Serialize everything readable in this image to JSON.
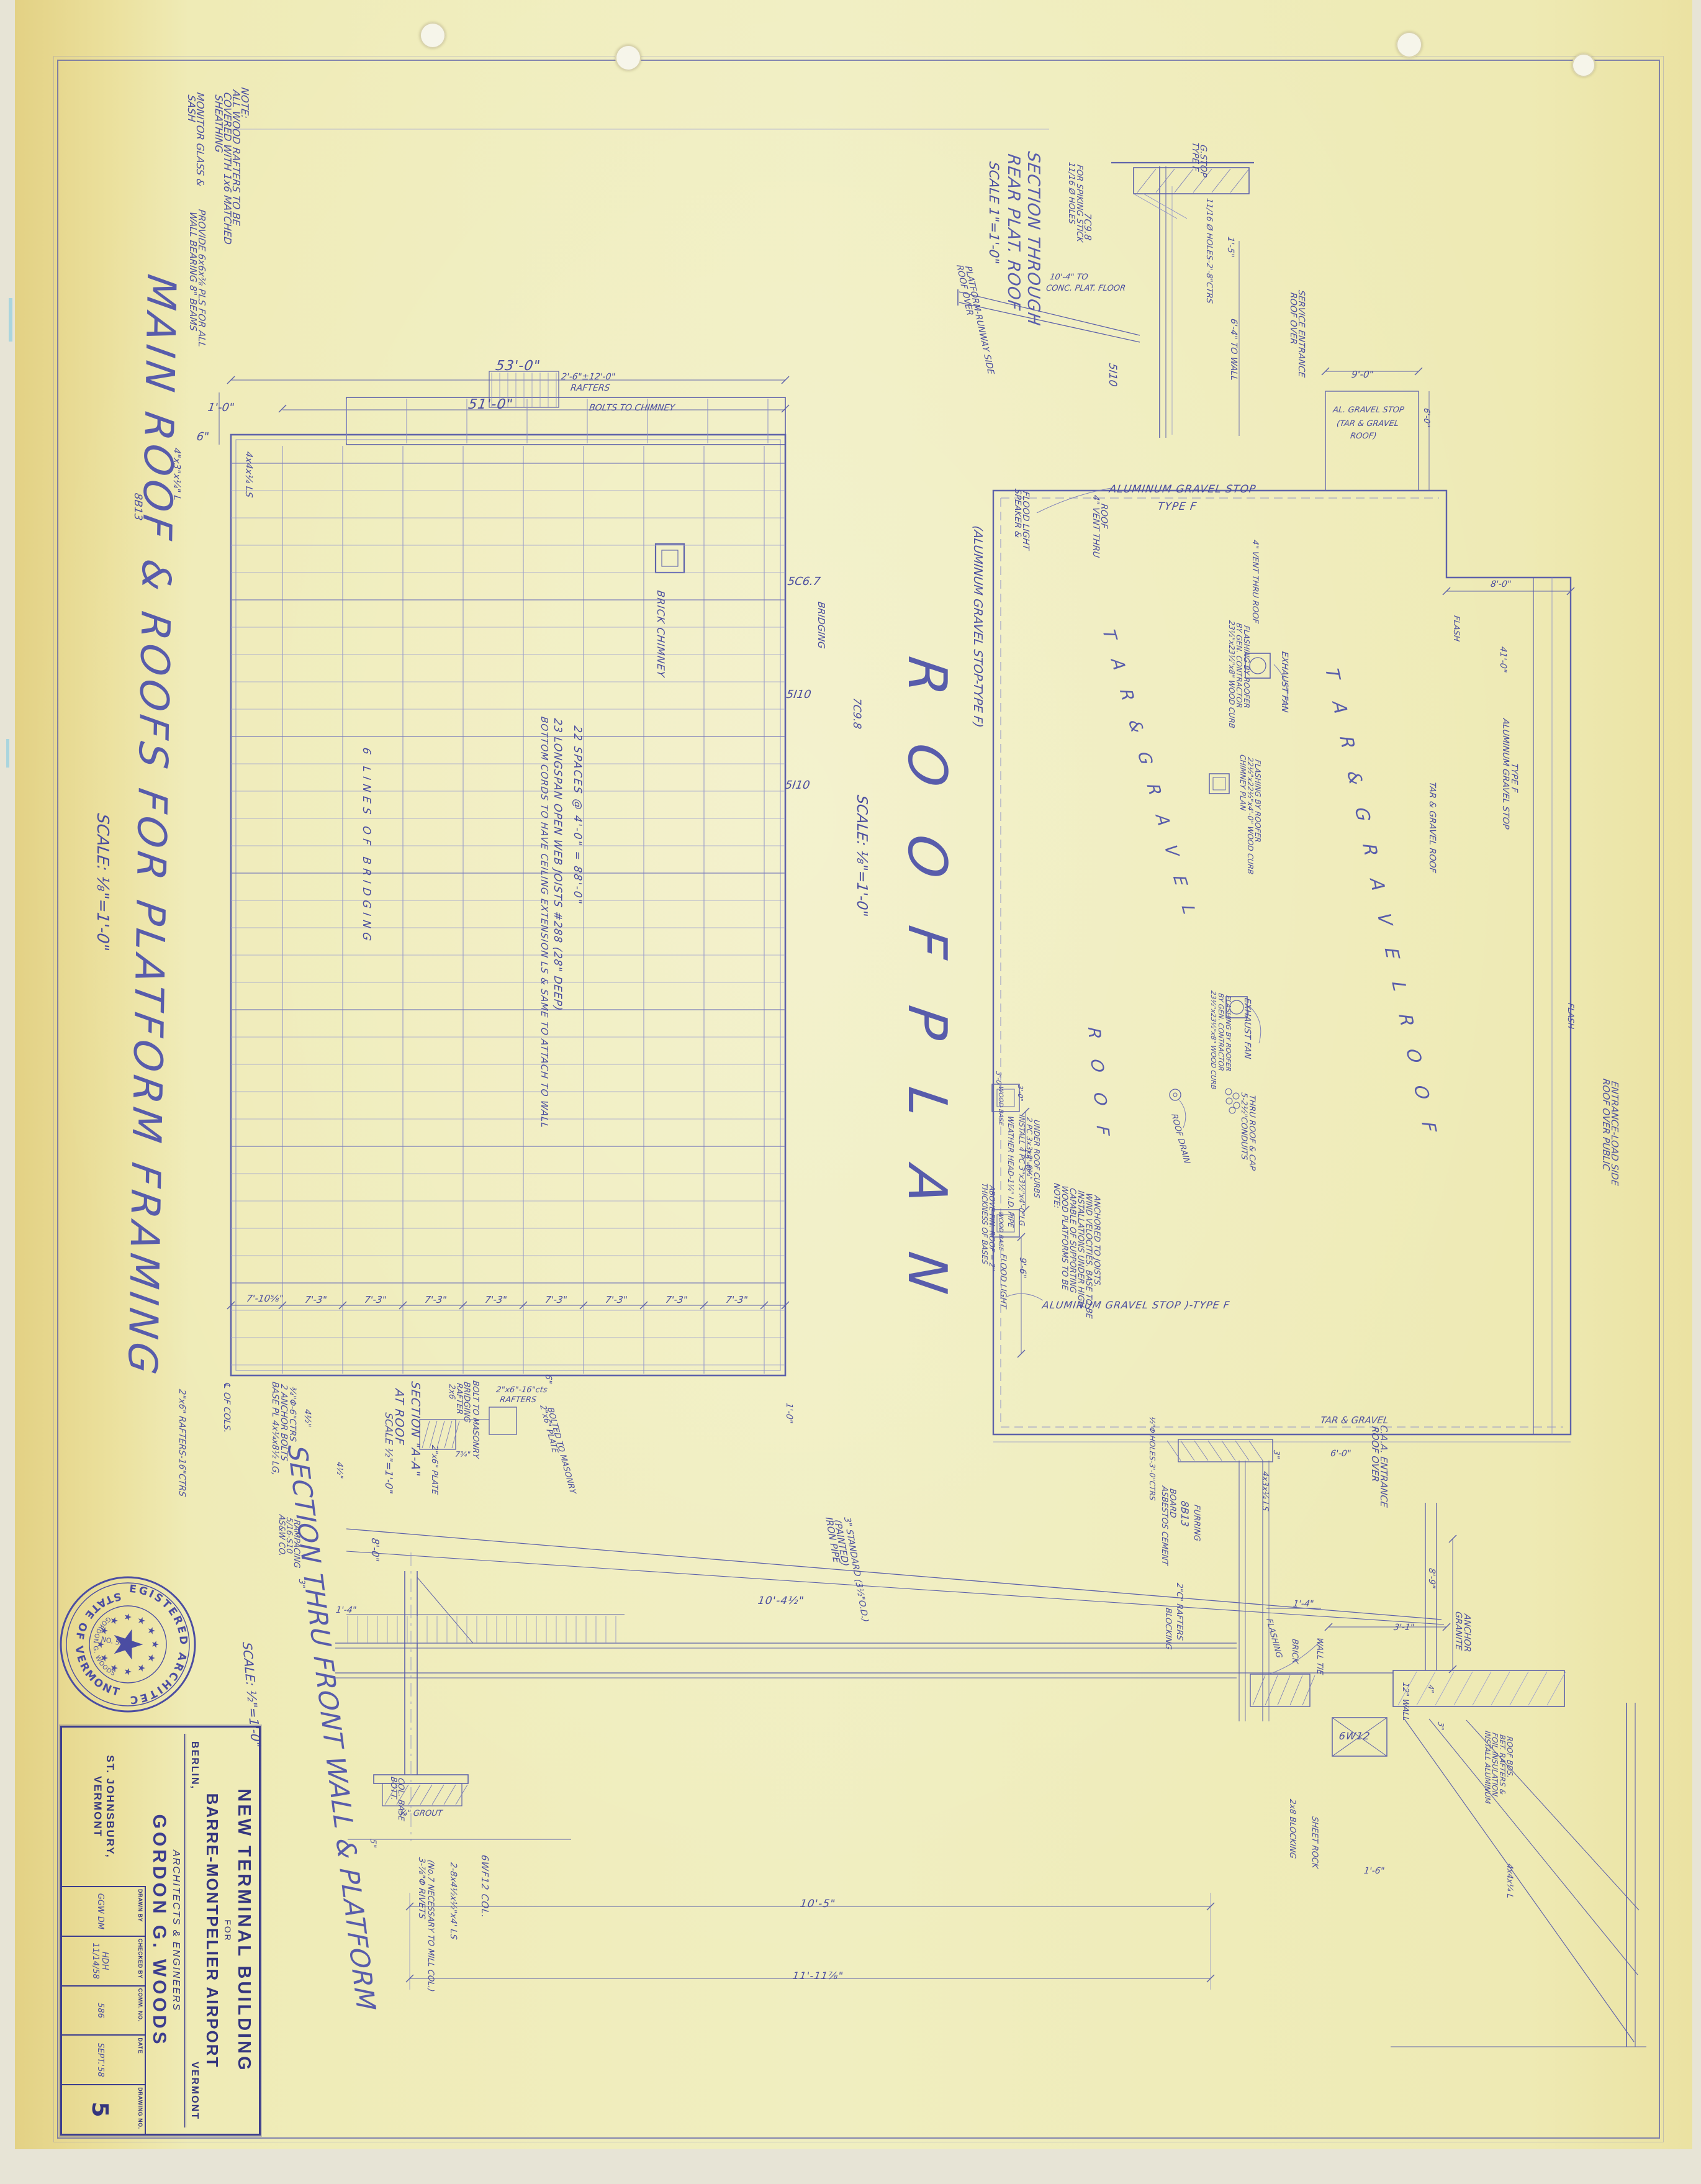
{
  "sheet": {
    "main_title": "MAIN ROOF & ROOFS FOR PLATFORM FRAMING",
    "main_title_scale": "SCALE: ⅛\"=1'-0\""
  },
  "title_block": {
    "project_title": "NEW TERMINAL BUILDING",
    "project_for": "FOR",
    "project_airport": "BARRE-MONTPELIER AIRPORT",
    "loc_left": "BERLIN,",
    "loc_right": "VERMONT",
    "arch_line": "ARCHITECTS & ENGINEERS",
    "firm": "GORDON G. WOODS",
    "firm_city": "ST. JOHNSBURY,  VERMONT",
    "fields": {
      "drawn_by_label": "DRAWN BY",
      "drawn_by": "GGW DM",
      "checked_by_label": "CHECKED BY",
      "checked_by": "HDH 11/14/58",
      "comm_no_label": "COMM. NO.",
      "comm_no": "586",
      "date_label": "DATE",
      "date": "SEPT.'58",
      "drawing_no_label": "DRAWING NO.",
      "drawing_no": "5"
    }
  },
  "seal": {
    "arc_top": "REGISTERED ARCHITECT",
    "arc_bottom": "STATE OF VERMONT",
    "inner_name": "GORDON G. WOODS",
    "number": "NO. 53",
    "star": "★"
  },
  "colors": {
    "ink": "#4a4da2",
    "ink_faint": "#9093c9",
    "paper": "#f0eec0"
  },
  "annotations": [
    {
      "id": "t_roofplan",
      "text": "R O O F   P L A N"
    },
    {
      "id": "t_roofplan_scale",
      "text": "SCALE: ⅛\"=1'-0\""
    },
    {
      "id": "t_roofplan_note",
      "text": "(ALUMINUM GRAVEL STOP-TYPE F)"
    },
    {
      "id": "t_rear1",
      "text": "SECTION THROUGH"
    },
    {
      "id": "t_rear2",
      "text": "REAR PLAT. ROOF"
    },
    {
      "id": "t_rear3",
      "text": "SCALE 1\"=1'-0\""
    },
    {
      "id": "t_front",
      "text": "SECTION THRU FRONT WALL & PLATFORM"
    },
    {
      "id": "t_front_scale",
      "text": "SCALE: ½\"=1'-0\""
    },
    {
      "id": "a7a",
      "text": "NOTE:"
    },
    {
      "id": "a7b",
      "text": "ALL WOOD RAFTERS TO BE"
    },
    {
      "id": "a7c",
      "text": "COVERED WITH 1x6 MATCHED"
    },
    {
      "id": "a7d",
      "text": "SHEATHING"
    },
    {
      "id": "a8a",
      "text": "MONITOR GLASS &"
    },
    {
      "id": "a8b",
      "text": "SASH"
    },
    {
      "id": "a1",
      "text": "53'-0\""
    },
    {
      "id": "a2",
      "text": "51'-0\""
    },
    {
      "id": "a3a",
      "text": "2'-6\"±12'-0\""
    },
    {
      "id": "a3b",
      "text": "RAFTERS"
    },
    {
      "id": "a4",
      "text": "1'-0\""
    },
    {
      "id": "a5",
      "text": "6\""
    },
    {
      "id": "a6a",
      "text": "PROVIDE 6x6x⅜ PLS FOR ALL"
    },
    {
      "id": "a6b",
      "text": "WALL BEARING 8\" BEAMS"
    },
    {
      "id": "a10",
      "text": "8B13"
    },
    {
      "id": "a11",
      "text": "4\"x3\"x¼\" L"
    },
    {
      "id": "a12",
      "text": "4x4x¼ LS"
    },
    {
      "id": "a17",
      "text": "BOLTS TO CHIMNEY"
    },
    {
      "id": "fp1",
      "text": "BRICK CHIMNEY"
    },
    {
      "id": "fp2",
      "text": "22 SPACES @ 4'-0\" = 88'-0\""
    },
    {
      "id": "fp3",
      "text": "23 LONGSPAN OPEN WEB JOISTS #288 (28\" DEEP)"
    },
    {
      "id": "fp3b",
      "text": "BOTTOM CORDS TO HAVE CEILING EXTENSION LS & SAME TO ATTACH TO WALL"
    },
    {
      "id": "fp4",
      "text": "6 LINES OF BRIDGING"
    },
    {
      "id": "fp5",
      "text": "5C6.7"
    },
    {
      "id": "fp6",
      "text": "BRIDGING"
    },
    {
      "id": "fp7",
      "text": "5I10"
    },
    {
      "id": "fp8",
      "text": "7C9.8"
    },
    {
      "id": "fp9",
      "text": "5I10"
    },
    {
      "id": "b0",
      "text": "7'-10⅝\""
    },
    {
      "id": "b1",
      "text": "7'-3\""
    },
    {
      "id": "b2",
      "text": "7'-3\""
    },
    {
      "id": "b3",
      "text": "7'-3\""
    },
    {
      "id": "b4",
      "text": "7'-3\""
    },
    {
      "id": "b5",
      "text": "7'-3\""
    },
    {
      "id": "b6",
      "text": "7'-3\""
    },
    {
      "id": "b7",
      "text": "7'-3\""
    },
    {
      "id": "b8",
      "text": "7'-3\""
    },
    {
      "id": "a15",
      "text": "2\"x6\" RAFTERS-16\"CTRS"
    },
    {
      "id": "sa_t1",
      "text": "SECTION \"A-A\""
    },
    {
      "id": "sa_t2",
      "text": "AT ROOF"
    },
    {
      "id": "sa_t3",
      "text": "SCALE ½\"=1'-0\""
    },
    {
      "id": "sa1",
      "text": "2x6"
    },
    {
      "id": "sa1b",
      "text": "RAFTER"
    },
    {
      "id": "sa2",
      "text": "BRIDGING"
    },
    {
      "id": "sa3",
      "text": "BOLT TO MASONRY"
    },
    {
      "id": "sa4",
      "text": "2\"x6\"-16\"cts"
    },
    {
      "id": "sa4b",
      "text": "RAFTERS"
    },
    {
      "id": "sa5",
      "text": "2\"x6\" PLATE"
    },
    {
      "id": "sa5b",
      "text": "BOLTED TO MASONRY"
    },
    {
      "id": "sa6",
      "text": "2\"x6\" PLATE"
    },
    {
      "id": "sa7",
      "text": "7¾\""
    },
    {
      "id": "sa66",
      "text": "6\""
    },
    {
      "id": "sa8",
      "text": "BASE PL 4x¼x8½ LG,"
    },
    {
      "id": "sa8b",
      "text": "2 ANCHOR BOLTS"
    },
    {
      "id": "sa8c",
      "text": "¾\"Φ-6\"CTRS"
    },
    {
      "id": "sa9",
      "text": "4½\""
    },
    {
      "id": "sa10",
      "text": "4½\""
    },
    {
      "id": "sa11",
      "text": "8'-0\""
    },
    {
      "id": "sa12",
      "text": "℄ OF COLS."
    },
    {
      "id": "sa13",
      "text": "AS&W CO."
    },
    {
      "id": "sa13b",
      "text": "5/16-S10"
    },
    {
      "id": "sa13c",
      "text": "RAMPACING"
    },
    {
      "id": "sa14",
      "text": "3\""
    },
    {
      "id": "sa15",
      "text": "1'-4\""
    },
    {
      "id": "sa17",
      "text": "IRON PIPE"
    },
    {
      "id": "sa17b",
      "text": "(PAINTED)"
    },
    {
      "id": "sa17c",
      "text": "3\" STANDARD (3½\"O.D.)"
    },
    {
      "id": "sa18",
      "text": "10'-4½\""
    },
    {
      "id": "sa19",
      "text": "1'-0\""
    },
    {
      "id": "sa20",
      "text": "10'-5\""
    },
    {
      "id": "sa21",
      "text": "11'-11⅞\""
    },
    {
      "id": "rw1",
      "text": "TAR & GRAVEL"
    },
    {
      "id": "rw2",
      "text": "ROOF OVER"
    },
    {
      "id": "rw2b",
      "text": "C.A.A. ENTRANCE"
    },
    {
      "id": "rw3",
      "text": "6'-0\""
    },
    {
      "id": "rw4",
      "text": "3\""
    },
    {
      "id": "rw5",
      "text": "4x3x¼ LS"
    },
    {
      "id": "rw6",
      "text": "8B13"
    },
    {
      "id": "rw7",
      "text": "FURRING"
    },
    {
      "id": "rw8",
      "text": "ASBESTOS CEMENT"
    },
    {
      "id": "rw8b",
      "text": "BOARD"
    },
    {
      "id": "rw9",
      "text": "2\"C\" RAFTERS"
    },
    {
      "id": "rw10",
      "text": "BLOCKING"
    },
    {
      "id": "rw11",
      "text": "½\"Φ HOLES-3'-0\"CTRS"
    },
    {
      "id": "rw12",
      "text": "1'-4\""
    },
    {
      "id": "rw13",
      "text": "3'-1\""
    },
    {
      "id": "rw14",
      "text": "8'-9\""
    },
    {
      "id": "rw15",
      "text": "GRANITE"
    },
    {
      "id": "rw15b",
      "text": "ANCHOR"
    },
    {
      "id": "rw16",
      "text": "12\" WALL"
    },
    {
      "id": "rw17",
      "text": "4\""
    },
    {
      "id": "rw18",
      "text": "3\""
    },
    {
      "id": "rw19",
      "text": "FLASHING"
    },
    {
      "id": "rw20",
      "text": "BRICK"
    },
    {
      "id": "rw21",
      "text": "WALL TIE"
    },
    {
      "id": "rw22",
      "text": "6W12"
    },
    {
      "id": "lc1",
      "text": "BOTT."
    },
    {
      "id": "lc1b",
      "text": "COL. BASE"
    },
    {
      "id": "lc2",
      "text": "¾\" GROUT"
    },
    {
      "id": "lc3",
      "text": "5\""
    },
    {
      "id": "lc4",
      "text": "6WF12 COL."
    },
    {
      "id": "lc5",
      "text": "2-8x4½x½\"x4' LS"
    },
    {
      "id": "lc6",
      "text": "3-⅞\"Φ RIVETS"
    },
    {
      "id": "lc6b",
      "text": "(No.7 NECESSARY TO MILL COL.)"
    },
    {
      "id": "br1",
      "text": "2x8 BLOCKING"
    },
    {
      "id": "br2",
      "text": "SHEET ROCK"
    },
    {
      "id": "br3",
      "text": "1'-6\""
    },
    {
      "id": "br4",
      "text": "INSTALL ALUMINUM"
    },
    {
      "id": "br4b",
      "text": "FOIL INSULATION"
    },
    {
      "id": "br4c",
      "text": "BET. RAFTERS &"
    },
    {
      "id": "br4d",
      "text": "ROOF BDS."
    },
    {
      "id": "br5",
      "text": "4x4x¼ L"
    },
    {
      "id": "ts1",
      "text": "TYPE F"
    },
    {
      "id": "ts1b",
      "text": "G.STOP"
    },
    {
      "id": "ts2",
      "text": "11/16 Ø HOLES"
    },
    {
      "id": "ts2b",
      "text": "FOR SPIKING STICK"
    },
    {
      "id": "ts3",
      "text": "7C9.8"
    },
    {
      "id": "ts4",
      "text": "10'-4\" TO"
    },
    {
      "id": "ts4b",
      "text": "CONC. PLAT. FLOOR"
    },
    {
      "id": "ts5",
      "text": "11/16 Ø HOLES-2'-8\"CTRS"
    },
    {
      "id": "ts6",
      "text": "1'-5\""
    },
    {
      "id": "ts7",
      "text": "6'-4\" TO WALL"
    },
    {
      "id": "ts8",
      "text": "ROOF OVER"
    },
    {
      "id": "ts8b",
      "text": "PLATFORM-RUNWAY SIDE"
    },
    {
      "id": "ts9",
      "text": "5I10"
    },
    {
      "id": "rp1",
      "text": "ALUMINUM GRAVEL STOP"
    },
    {
      "id": "rp1b",
      "text": "TYPE F"
    },
    {
      "id": "rp2",
      "text": "SPEAKER &"
    },
    {
      "id": "rp2b",
      "text": "FLOOD LIGHT"
    },
    {
      "id": "rp3",
      "text": "4\" VENT THRU"
    },
    {
      "id": "rp3b",
      "text": "ROOF"
    },
    {
      "id": "rp4",
      "text": "EXHAUST FAN"
    },
    {
      "id": "rp5",
      "text": "23½\"x23½\"x8\" WOOD CURB"
    },
    {
      "id": "rp5b",
      "text": "BY GEN. CONTRACTOR"
    },
    {
      "id": "rp5c",
      "text": "FLASHING BY ROOFER"
    },
    {
      "id": "rp6",
      "text": "4\" VENT THRU ROOF"
    },
    {
      "id": "rp7",
      "text": "T A R   &   G R A V E L"
    },
    {
      "id": "rp7b",
      "text": "R O O F"
    },
    {
      "id": "rp8",
      "text": "T A R   &   G R A V E L   R O O F"
    },
    {
      "id": "rp9",
      "text": "ROOF DRAIN"
    },
    {
      "id": "rp10",
      "text": "5-2½\"CONDUITS"
    },
    {
      "id": "rp10b",
      "text": "THRU ROOF & CAP"
    },
    {
      "id": "rp11",
      "text": "EXHAUST FAN"
    },
    {
      "id": "rp12",
      "text": "23½\"x23½\"x8\" WOOD CURB"
    },
    {
      "id": "rp12b",
      "text": "BY GEN. CONTRACTOR"
    },
    {
      "id": "rp12c",
      "text": "FLASHING BY ROOFER"
    },
    {
      "id": "rp13a",
      "text": "WOOD BASE"
    },
    {
      "id": "rp13b",
      "text": "WOOD BASE"
    },
    {
      "id": "rp14",
      "text": "INSTALL 4 PC 3\"x3½\"x4'-0\"LG"
    },
    {
      "id": "rp14b",
      "text": "2 PC 3x3x2'-6¼\""
    },
    {
      "id": "rp14c",
      "text": "UNDER ROOF CURBS"
    },
    {
      "id": "rp15",
      "text": "WEATHER HEAD-1¼\" I.D. PIPE"
    },
    {
      "id": "rp16",
      "text": "NOTE:"
    },
    {
      "id": "rp16b",
      "text": "WOOD PLATFORMS TO BE"
    },
    {
      "id": "rp16c",
      "text": "CAPABLE OF SUPPORTING"
    },
    {
      "id": "rp16d",
      "text": "INSTALLATIONS UNDER HIGH"
    },
    {
      "id": "rp16e",
      "text": "WIND VELOCITIES. BASE TO BE"
    },
    {
      "id": "rp16f",
      "text": "ANCHORED TO JOISTS."
    },
    {
      "id": "rp17",
      "text": "FLOOD LIGHT"
    },
    {
      "id": "rp18",
      "text": "THICKNESS OF BASES"
    },
    {
      "id": "rp18b",
      "text": "ABOVE FIN. ROOF = 2\""
    },
    {
      "id": "rp19",
      "text": "15'-0\""
    },
    {
      "id": "rp20",
      "text": "9'-6\""
    },
    {
      "id": "rp21a",
      "text": "3'-0\""
    },
    {
      "id": "rp21b",
      "text": "3'-0\""
    },
    {
      "id": "rp22",
      "text": "ALUMINUM GRAVEL STOP )-TYPE F"
    },
    {
      "id": "rp23",
      "text": "FLASH"
    },
    {
      "id": "rp24",
      "text": "ALUMINUM GRAVEL STOP"
    },
    {
      "id": "rp24b",
      "text": "TYPE F"
    },
    {
      "id": "rp25",
      "text": "TAR & GRAVEL ROOF"
    },
    {
      "id": "rp26",
      "text": "FLASH"
    },
    {
      "id": "rp27",
      "text": "8'-0\""
    },
    {
      "id": "rp28",
      "text": "ROOF OVER"
    },
    {
      "id": "rp28b",
      "text": "SERVICE ENTRANCE"
    },
    {
      "id": "rp29",
      "text": "9'-0\""
    },
    {
      "id": "rp30",
      "text": "AL. GRAVEL STOP"
    },
    {
      "id": "rp30b",
      "text": "(TAR & GRAVEL"
    },
    {
      "id": "rp30c",
      "text": "ROOF)"
    },
    {
      "id": "rp31",
      "text": "6'-0\""
    },
    {
      "id": "rp32",
      "text": "ROOF OVER PUBLIC"
    },
    {
      "id": "rp32b",
      "text": "ENTRANCE-LOAD SIDE"
    },
    {
      "id": "rp34",
      "text": "41'-0\""
    },
    {
      "id": "rp35",
      "text": "CHIMNEY PLAN"
    },
    {
      "id": "rp35b",
      "text": "22½\"x22½\"x4'-0\" WOOD CURB"
    },
    {
      "id": "rp35c",
      "text": "FLASHING BY ROOFER"
    }
  ]
}
